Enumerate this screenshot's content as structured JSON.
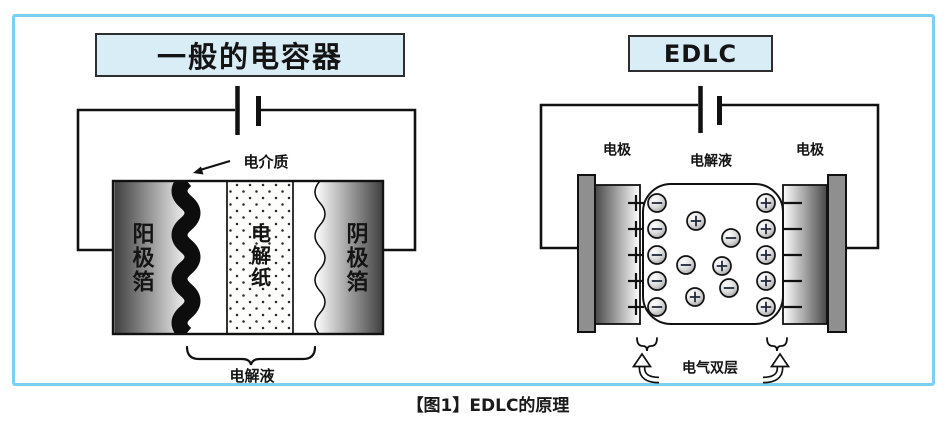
{
  "caption": "【图1】EDLC的原理",
  "colors": {
    "frame_border": "#7bd0f1",
    "title_box_fill": "#d9edf7",
    "title_box_border": "#2e2e2e",
    "diagram_ink": "#111111",
    "collector_gray": "#8f8f8f",
    "ion_sign": "#202a3c"
  },
  "left_diagram": {
    "title": "一般的电容器",
    "dielectric_label": "电介质",
    "anode_foil_label": "阳极箔",
    "separator_paper_label": "电解纸",
    "cathode_foil_label": "阴极箔",
    "electrolyte_label": "电解液"
  },
  "right_diagram": {
    "title": "EDLC",
    "electrode_left_label": "电极",
    "electrolyte_label": "电解液",
    "electrode_right_label": "电极",
    "double_layer_label": "电气双层",
    "figure": {
      "row_ys": [
        203,
        229,
        255,
        281,
        307
      ],
      "left_column_x": 657,
      "right_column_x": 766,
      "plus_marks_x": 636,
      "minus_marks_x1": 784,
      "minus_marks_x2": 802,
      "scattered_ions": [
        {
          "x": 696,
          "y": 221,
          "sign": "+"
        },
        {
          "x": 731,
          "y": 238,
          "sign": "-"
        },
        {
          "x": 686,
          "y": 265,
          "sign": "-"
        },
        {
          "x": 722,
          "y": 266,
          "sign": "+"
        },
        {
          "x": 729,
          "y": 288,
          "sign": "-"
        },
        {
          "x": 695,
          "y": 297,
          "sign": "+"
        }
      ]
    }
  }
}
